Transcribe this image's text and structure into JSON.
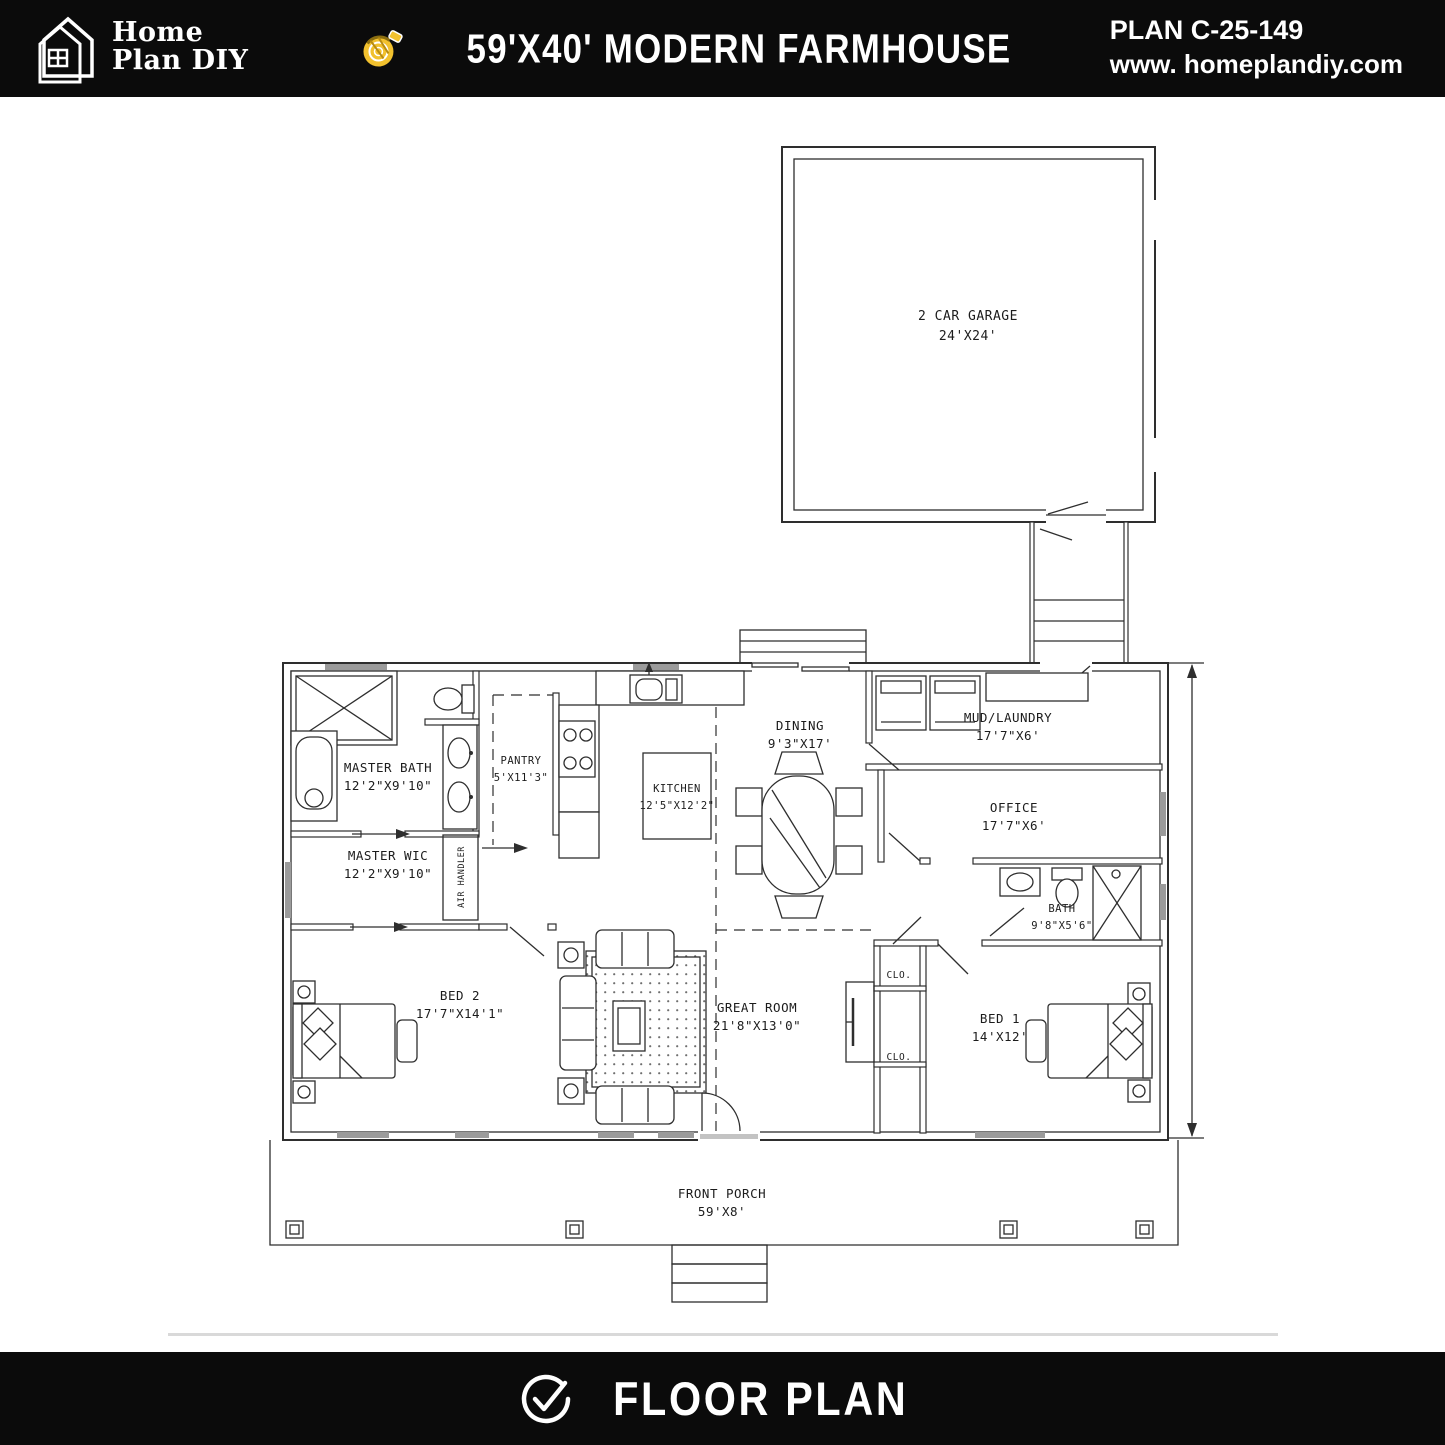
{
  "header": {
    "logo_line1": "Home",
    "logo_line2": "Plan DIY",
    "logo_icon": "house-outline-icon",
    "title_icon": "tape-measure-icon",
    "title": "59'X40' MODERN FARMHOUSE",
    "plan_number": "PLAN C-25-149",
    "website": "www. homeplandiy.com"
  },
  "footer": {
    "icon": "check-circle-icon",
    "label": "FLOOR PLAN"
  },
  "colors": {
    "bar_black": "#0b0b0b",
    "accent_yellow": "#f2c12e",
    "plan_line": "#2e2e2e",
    "window_gray": "#9b9b9b",
    "divider_gray": "#d9d9d9"
  },
  "floor_plan": {
    "rooms": [
      {
        "name": "2 CAR GARAGE",
        "dims": "24'X24'"
      },
      {
        "name": "MASTER BATH",
        "dims": "12'2\"X9'10\""
      },
      {
        "name": "MASTER WIC",
        "dims": "12'2\"X9'10\""
      },
      {
        "name": "PANTRY",
        "dims": "5'X11'3\""
      },
      {
        "name": "KITCHEN",
        "dims": "12'5\"X12'2\""
      },
      {
        "name": "DINING",
        "dims": "9'3\"X17'"
      },
      {
        "name": "MUD/LAUNDRY",
        "dims": "17'7\"X6'"
      },
      {
        "name": "OFFICE",
        "dims": "17'7\"X6'"
      },
      {
        "name": "BATH",
        "dims": "9'8\"X5'6\""
      },
      {
        "name": "BED 2",
        "dims": "17'7\"X14'1\""
      },
      {
        "name": "GREAT ROOM",
        "dims": "21'8\"X13'0\""
      },
      {
        "name": "BED 1",
        "dims": "14'X12'"
      },
      {
        "name": "CLO."
      },
      {
        "name": "CLO."
      },
      {
        "name": "FRONT PORCH",
        "dims": "59'X8'"
      },
      {
        "name": "AIR HANDLER"
      }
    ]
  }
}
